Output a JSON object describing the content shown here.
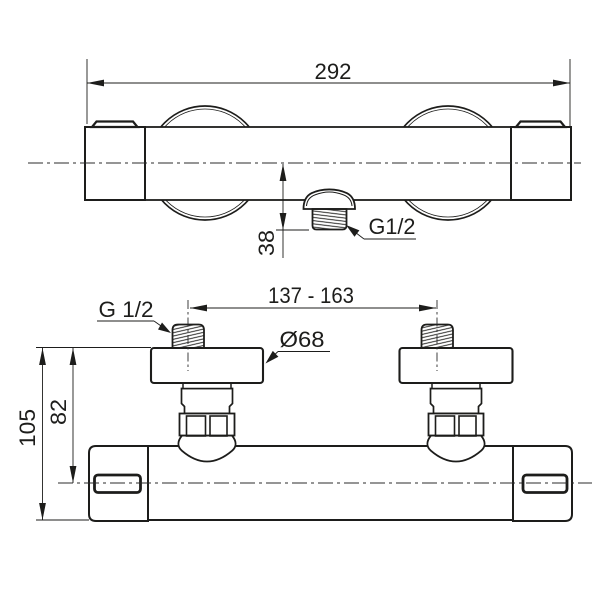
{
  "colors": {
    "line": "#1d1d1b",
    "background": "#ffffff"
  },
  "top_view": {
    "width_dim": "292",
    "outlet_drop_dim": "38",
    "outlet_thread_label": "G1/2"
  },
  "bottom_view": {
    "connection_centers_dim": "137 - 163",
    "inlet_thread_label": "G 1/2",
    "escutcheon_diameter_label": "Ø68",
    "overall_height_dim": "105",
    "center_height_dim": "82"
  }
}
